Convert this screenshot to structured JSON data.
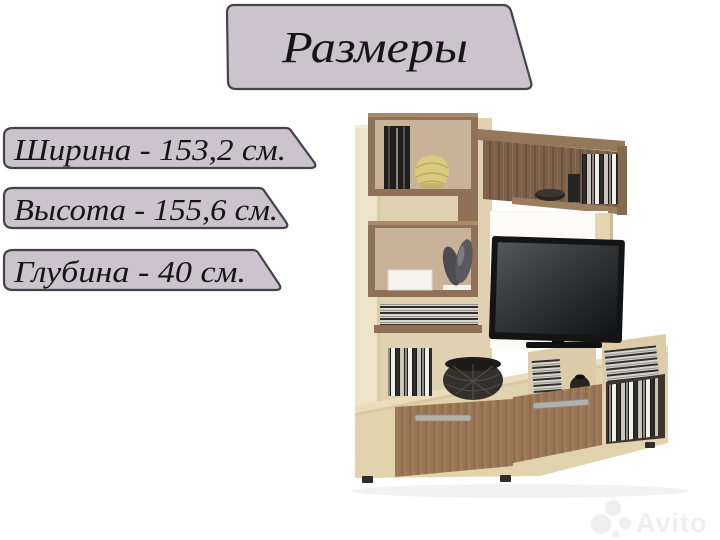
{
  "background": "#ffffff",
  "banner_style": {
    "fill": "#CBC4CD",
    "border": "#46424A",
    "text_color": "#151515"
  },
  "title_banner": {
    "text": "Размеры"
  },
  "dimensions": [
    {
      "name": "width",
      "label": "Ширина - 153,2 см."
    },
    {
      "name": "height",
      "label": "Высота - 155,6 см."
    },
    {
      "name": "depth",
      "label": "Глубина - 40 см."
    }
  ],
  "furniture": {
    "kind": "tv-wall-unit-photo",
    "colors": {
      "side_panel": "#EDE4C9",
      "beige_back": "#DFD1B2",
      "tan_back": "#C9B398",
      "walnut_frame": "#8E7156",
      "walnut_dark": "#7B6149",
      "door_wood": "#9A7757",
      "cabinet_face": "#E4D5B2",
      "tv_black": "#141414",
      "sphere_yellow": "#D9CB7D",
      "basket_dark": "#332F2B",
      "white_panel": "#FCFBF8",
      "handle_metal": "#B4B1AA"
    }
  },
  "watermark": {
    "text": "Avito",
    "color": "#EFEEF1"
  }
}
